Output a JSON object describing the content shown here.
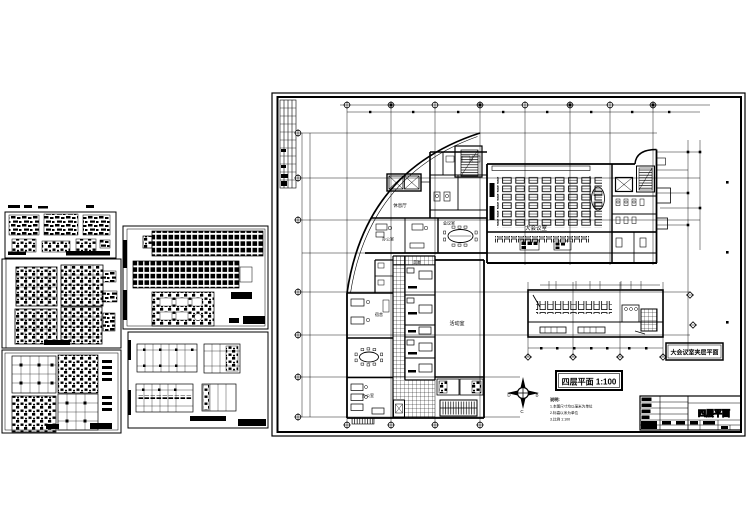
{
  "colors": {
    "ink": "#000000",
    "paper": "#ffffff"
  },
  "sheet": {
    "plan_title": "四层平面 1:100",
    "mezzanine_label": "大会议室夹层平面",
    "rooms": {
      "auditorium": "大会议室",
      "lounge": "休息厅",
      "meeting": "会议室",
      "office_top": "办公室",
      "corridor": "走廊",
      "activity": "活动室",
      "dorm": "宿舍",
      "office_bottom": "办公室"
    },
    "notes": {
      "title": "说明:",
      "line1": "1.本图尺寸均以毫米为单位",
      "line2": "2.标高以米为单位",
      "line3": "3.比例 1:100"
    },
    "compass": {
      "left": "D",
      "right": "B",
      "bottom": "C"
    },
    "titleblock": {
      "drawing_name": "四层平面"
    }
  }
}
